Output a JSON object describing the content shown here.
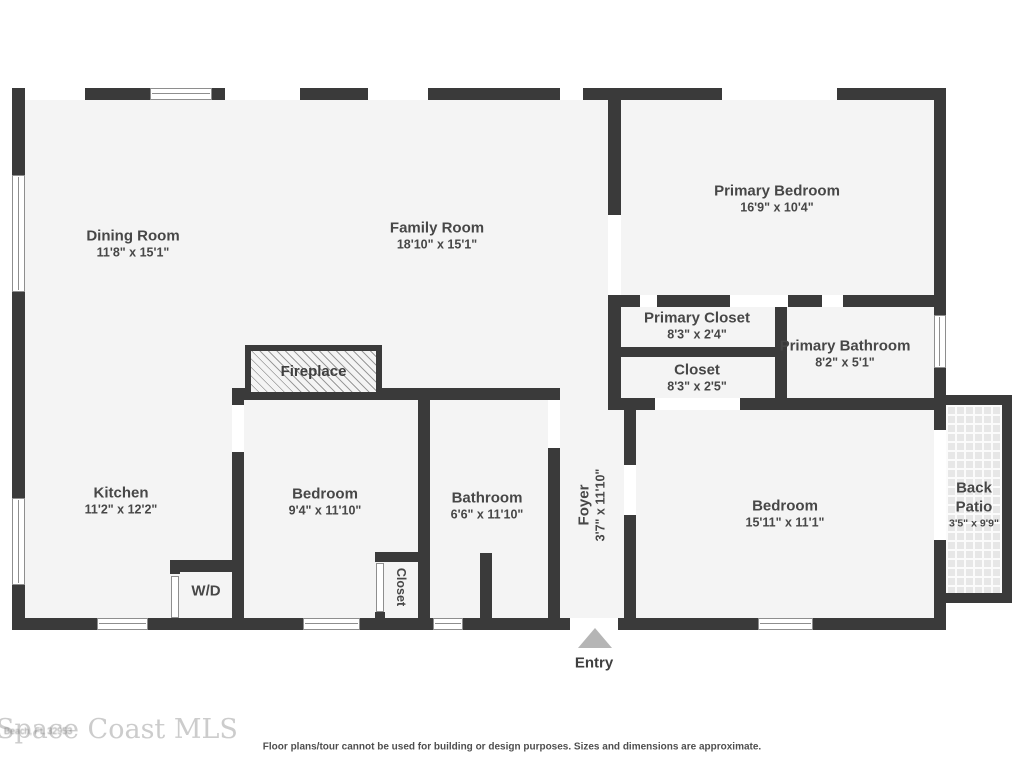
{
  "floorplan": {
    "rooms": {
      "dining": {
        "name": "Dining Room",
        "dims": "11'8\" x 15'1\""
      },
      "family": {
        "name": "Family Room",
        "dims": "18'10\" x 15'1\""
      },
      "primary_bedroom": {
        "name": "Primary Bedroom",
        "dims": "16'9\" x 10'4\""
      },
      "primary_closet": {
        "name": "Primary Closet",
        "dims": "8'3\" x 2'4\""
      },
      "hall_closet": {
        "name": "Closet",
        "dims": "8'3\" x 2'5\""
      },
      "primary_bath": {
        "name": "Primary Bathroom",
        "dims": "8'2\" x 5'1\""
      },
      "kitchen": {
        "name": "Kitchen",
        "dims": "11'2\" x 12'2\""
      },
      "bedroom2": {
        "name": "Bedroom",
        "dims": "9'4\" x 11'10\""
      },
      "bathroom": {
        "name": "Bathroom",
        "dims": "6'6\" x 11'10\""
      },
      "foyer": {
        "name": "Foyer",
        "dims": "3'7\" x 11'10\""
      },
      "bedroom3": {
        "name": "Bedroom",
        "dims": "15'11\" x 11'1\""
      },
      "back_patio": {
        "name": "Back Patio",
        "dims": "3'5\" x 9'9\""
      }
    },
    "features": {
      "fireplace": "Fireplace",
      "washer_dryer": "W/D",
      "small_closet": "Closet",
      "entry": "Entry"
    },
    "footer": {
      "watermark": "Space Coast MLS",
      "address_fragment": "Beach, FL 32953",
      "disclaimer": "Floor plans/tour cannot be used for building or design purposes. Sizes and dimensions are approximate."
    },
    "colors": {
      "wall": "#3a3a3a",
      "floor": "#f4f4f4",
      "entry_arrow": "#b5b5b5"
    }
  }
}
